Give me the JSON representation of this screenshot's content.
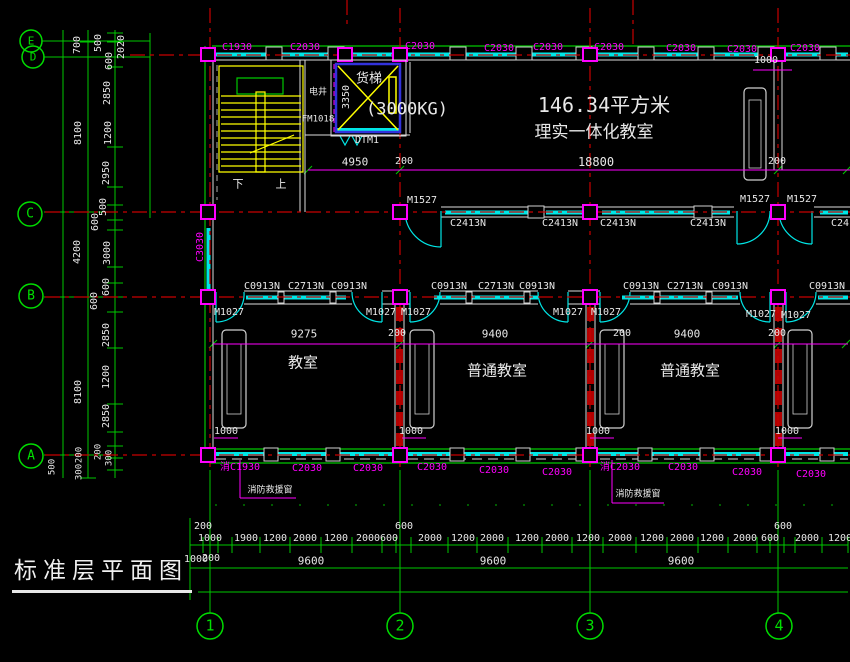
{
  "title": {
    "text": "标准层平面图"
  },
  "colors": {
    "background": "#000000",
    "grid_red": "#c80000",
    "dim_green": "#00d200",
    "window_cyan": "#00e6e6",
    "label_magenta": "#ff00ff",
    "stair_yellow": "#ffff00",
    "text_white": "#e8e8e8",
    "elevator_blue": "#3232dc"
  },
  "axis_bubbles": {
    "left": [
      "E",
      "D",
      "C",
      "B",
      "A"
    ],
    "bottom": [
      "1",
      "2",
      "3",
      "4"
    ]
  },
  "rooms": [
    "理实一体化教室",
    "教室",
    "普通教室",
    "普通教室",
    "电井",
    "货梯"
  ],
  "texts": [
    {
      "n": "dim-left",
      "t": "700",
      "x": 78,
      "y": 45,
      "s": 10,
      "r": 1
    },
    {
      "n": "dim-left",
      "t": "500",
      "x": 99,
      "y": 43,
      "s": 10,
      "r": 1
    },
    {
      "n": "dim-left",
      "t": "600",
      "x": 110,
      "y": 61,
      "s": 10,
      "r": 1
    },
    {
      "n": "dim-left",
      "t": "2020",
      "x": 122,
      "y": 47,
      "s": 10,
      "r": 1
    },
    {
      "n": "dim-left",
      "t": "2850",
      "x": 108,
      "y": 93,
      "s": 10,
      "r": 1
    },
    {
      "n": "dim-left",
      "t": "8100",
      "x": 79,
      "y": 133,
      "s": 10,
      "r": 1
    },
    {
      "n": "dim-left",
      "t": "1200",
      "x": 109,
      "y": 133,
      "s": 10,
      "r": 1
    },
    {
      "n": "dim-left",
      "t": "2950",
      "x": 107,
      "y": 173,
      "s": 10,
      "r": 1
    },
    {
      "n": "dim-left",
      "t": "500",
      "x": 104,
      "y": 207,
      "s": 10,
      "r": 1
    },
    {
      "n": "dim-left",
      "t": "600",
      "x": 96,
      "y": 222,
      "s": 10,
      "r": 1
    },
    {
      "n": "dim-left",
      "t": "4200",
      "x": 78,
      "y": 252,
      "s": 10,
      "r": 1
    },
    {
      "n": "dim-left",
      "t": "3000",
      "x": 108,
      "y": 253,
      "s": 10,
      "r": 1
    },
    {
      "n": "dim-left",
      "t": "600",
      "x": 107,
      "y": 287,
      "s": 10,
      "r": 1
    },
    {
      "n": "dim-left",
      "t": "600",
      "x": 95,
      "y": 301,
      "s": 10,
      "r": 1
    },
    {
      "n": "dim-left",
      "t": "2850",
      "x": 107,
      "y": 335,
      "s": 10,
      "r": 1
    },
    {
      "n": "dim-left",
      "t": "8100",
      "x": 79,
      "y": 392,
      "s": 10,
      "r": 1
    },
    {
      "n": "dim-left",
      "t": "1200",
      "x": 107,
      "y": 377,
      "s": 10,
      "r": 1
    },
    {
      "n": "dim-left",
      "t": "2850",
      "x": 107,
      "y": 416,
      "s": 10,
      "r": 1
    },
    {
      "n": "dim-left",
      "t": "500",
      "x": 53,
      "y": 467,
      "s": 9,
      "r": 1
    },
    {
      "n": "dim-left",
      "t": "200",
      "x": 80,
      "y": 455,
      "s": 9,
      "r": 1
    },
    {
      "n": "dim-left",
      "t": "300",
      "x": 80,
      "y": 472,
      "s": 9,
      "r": 1
    },
    {
      "n": "dim-left",
      "t": "200",
      "x": 99,
      "y": 452,
      "s": 9,
      "r": 1
    },
    {
      "n": "dim-left",
      "t": "300",
      "x": 110,
      "y": 458,
      "s": 9,
      "r": 1
    },
    {
      "n": "window-label-top",
      "t": "C1930",
      "x": 237,
      "y": 48,
      "s": 10,
      "c": "#ff00ff"
    },
    {
      "n": "window-label-top",
      "t": "C2030",
      "x": 305,
      "y": 48,
      "s": 10,
      "c": "#ff00ff"
    },
    {
      "n": "window-label-top",
      "t": "C2030",
      "x": 420,
      "y": 47,
      "s": 10,
      "c": "#ff00ff"
    },
    {
      "n": "window-label-top",
      "t": "C2030",
      "x": 499,
      "y": 49,
      "s": 10,
      "c": "#ff00ff"
    },
    {
      "n": "window-label-top",
      "t": "C2030",
      "x": 548,
      "y": 48,
      "s": 10,
      "c": "#ff00ff"
    },
    {
      "n": "window-label-top",
      "t": "C2030",
      "x": 609,
      "y": 48,
      "s": 10,
      "c": "#ff00ff"
    },
    {
      "n": "window-label-top",
      "t": "C2030",
      "x": 681,
      "y": 49,
      "s": 10,
      "c": "#ff00ff"
    },
    {
      "n": "window-label-top",
      "t": "C2030",
      "x": 742,
      "y": 50,
      "s": 10,
      "c": "#ff00ff"
    },
    {
      "n": "window-label-top",
      "t": "C2030",
      "x": 805,
      "y": 49,
      "s": 10,
      "c": "#ff00ff"
    },
    {
      "n": "dim-plan",
      "t": "1000",
      "x": 766,
      "y": 61,
      "s": 10
    },
    {
      "n": "room-label-shaft",
      "t": "电井",
      "x": 318,
      "y": 93,
      "s": 9
    },
    {
      "n": "door-label",
      "t": "FM1018",
      "x": 318,
      "y": 120,
      "s": 9
    },
    {
      "n": "room-label-elevator",
      "t": "货梯",
      "x": 369,
      "y": 79,
      "s": 13
    },
    {
      "n": "dim-plan",
      "t": "3350",
      "x": 347,
      "y": 97,
      "s": 10,
      "r": 1
    },
    {
      "n": "elevator-capacity",
      "t": "(3000KG)",
      "x": 407,
      "y": 110,
      "s": 17
    },
    {
      "n": "elevator-tag",
      "t": "DTM1",
      "x": 367,
      "y": 141,
      "s": 10
    },
    {
      "n": "stair-down-label",
      "t": "下",
      "x": 238,
      "y": 184,
      "s": 11
    },
    {
      "n": "stair-up-label",
      "t": "上",
      "x": 281,
      "y": 184,
      "s": 11
    },
    {
      "n": "dim-plan",
      "t": "4950",
      "x": 355,
      "y": 162,
      "s": 11
    },
    {
      "n": "dim-plan",
      "t": "200",
      "x": 404,
      "y": 162,
      "s": 10
    },
    {
      "n": "dim-plan",
      "t": "18800",
      "x": 596,
      "y": 162,
      "s": 12
    },
    {
      "n": "dim-plan",
      "t": "200",
      "x": 777,
      "y": 162,
      "s": 10
    },
    {
      "n": "room-area-label",
      "t": "146.34平方米",
      "x": 604,
      "y": 105,
      "s": 20
    },
    {
      "n": "room-label",
      "t": "理实一体化教室",
      "x": 594,
      "y": 133,
      "s": 17
    },
    {
      "n": "door-label",
      "t": "M1527",
      "x": 422,
      "y": 201,
      "s": 10
    },
    {
      "n": "window-label",
      "t": "C2413N",
      "x": 468,
      "y": 224,
      "s": 10
    },
    {
      "n": "window-label",
      "t": "C2413N",
      "x": 560,
      "y": 224,
      "s": 10
    },
    {
      "n": "window-label",
      "t": "C2413N",
      "x": 618,
      "y": 224,
      "s": 10
    },
    {
      "n": "window-label",
      "t": "C2413N",
      "x": 708,
      "y": 224,
      "s": 10
    },
    {
      "n": "door-label",
      "t": "M1527",
      "x": 755,
      "y": 200,
      "s": 10
    },
    {
      "n": "door-label",
      "t": "M1527",
      "x": 802,
      "y": 200,
      "s": 10
    },
    {
      "n": "window-label",
      "t": "C2413N",
      "x": 849,
      "y": 224,
      "s": 10
    },
    {
      "n": "window-label",
      "t": "C3030",
      "x": 201,
      "y": 247,
      "s": 10,
      "r": 1,
      "c": "#ff00ff"
    },
    {
      "n": "window-label",
      "t": "C0913N",
      "x": 262,
      "y": 287,
      "s": 10
    },
    {
      "n": "window-label",
      "t": "C2713N",
      "x": 306,
      "y": 287,
      "s": 10
    },
    {
      "n": "window-label",
      "t": "C0913N",
      "x": 349,
      "y": 287,
      "s": 10
    },
    {
      "n": "window-label",
      "t": "C0913N",
      "x": 449,
      "y": 287,
      "s": 10
    },
    {
      "n": "window-label",
      "t": "C2713N",
      "x": 496,
      "y": 287,
      "s": 10
    },
    {
      "n": "window-label",
      "t": "C0913N",
      "x": 537,
      "y": 287,
      "s": 10
    },
    {
      "n": "window-label",
      "t": "C0913N",
      "x": 641,
      "y": 287,
      "s": 10
    },
    {
      "n": "window-label",
      "t": "C2713N",
      "x": 685,
      "y": 287,
      "s": 10
    },
    {
      "n": "window-label",
      "t": "C0913N",
      "x": 730,
      "y": 287,
      "s": 10
    },
    {
      "n": "window-label",
      "t": "C0913N",
      "x": 827,
      "y": 287,
      "s": 10
    },
    {
      "n": "door-label",
      "t": "M1027",
      "x": 229,
      "y": 313,
      "s": 10
    },
    {
      "n": "door-label",
      "t": "M1027",
      "x": 381,
      "y": 313,
      "s": 10
    },
    {
      "n": "door-label",
      "t": "M1027",
      "x": 416,
      "y": 313,
      "s": 10
    },
    {
      "n": "door-label",
      "t": "M1027",
      "x": 568,
      "y": 313,
      "s": 10
    },
    {
      "n": "door-label",
      "t": "M1027",
      "x": 606,
      "y": 313,
      "s": 10
    },
    {
      "n": "door-label",
      "t": "M1027",
      "x": 761,
      "y": 315,
      "s": 10
    },
    {
      "n": "door-label",
      "t": "M1027",
      "x": 796,
      "y": 316,
      "s": 10
    },
    {
      "n": "dim-plan",
      "t": "9275",
      "x": 304,
      "y": 334,
      "s": 11
    },
    {
      "n": "dim-plan",
      "t": "200",
      "x": 397,
      "y": 334,
      "s": 10
    },
    {
      "n": "dim-plan",
      "t": "9400",
      "x": 495,
      "y": 334,
      "s": 11
    },
    {
      "n": "dim-plan",
      "t": "200",
      "x": 622,
      "y": 334,
      "s": 10
    },
    {
      "n": "dim-plan",
      "t": "9400",
      "x": 687,
      "y": 334,
      "s": 11
    },
    {
      "n": "dim-plan",
      "t": "200",
      "x": 777,
      "y": 334,
      "s": 10
    },
    {
      "n": "room-label",
      "t": "教室",
      "x": 303,
      "y": 363,
      "s": 15
    },
    {
      "n": "room-label",
      "t": "普通教室",
      "x": 497,
      "y": 371,
      "s": 15
    },
    {
      "n": "room-label",
      "t": "普通教室",
      "x": 690,
      "y": 371,
      "s": 15
    },
    {
      "n": "dim-plan",
      "t": "1000",
      "x": 226,
      "y": 432,
      "s": 10
    },
    {
      "n": "dim-plan",
      "t": "1000",
      "x": 411,
      "y": 432,
      "s": 10
    },
    {
      "n": "dim-plan",
      "t": "1000",
      "x": 598,
      "y": 432,
      "s": 10
    },
    {
      "n": "dim-plan",
      "t": "1000",
      "x": 787,
      "y": 432,
      "s": 10
    },
    {
      "n": "window-label-bottom",
      "t": "消C1930",
      "x": 240,
      "y": 468,
      "s": 10,
      "c": "#ff00ff"
    },
    {
      "n": "window-label-bottom",
      "t": "C2030",
      "x": 307,
      "y": 469,
      "s": 10,
      "c": "#ff00ff"
    },
    {
      "n": "window-label-bottom",
      "t": "C2030",
      "x": 368,
      "y": 469,
      "s": 10,
      "c": "#ff00ff"
    },
    {
      "n": "window-label-bottom",
      "t": "C2030",
      "x": 432,
      "y": 468,
      "s": 10,
      "c": "#ff00ff"
    },
    {
      "n": "window-label-bottom",
      "t": "C2030",
      "x": 494,
      "y": 471,
      "s": 10,
      "c": "#ff00ff"
    },
    {
      "n": "window-label-bottom",
      "t": "C2030",
      "x": 557,
      "y": 473,
      "s": 10,
      "c": "#ff00ff"
    },
    {
      "n": "window-label-bottom",
      "t": "消C2030",
      "x": 620,
      "y": 468,
      "s": 10,
      "c": "#ff00ff"
    },
    {
      "n": "window-label-bottom",
      "t": "C2030",
      "x": 683,
      "y": 468,
      "s": 10,
      "c": "#ff00ff"
    },
    {
      "n": "window-label-bottom",
      "t": "C2030",
      "x": 747,
      "y": 473,
      "s": 10,
      "c": "#ff00ff"
    },
    {
      "n": "window-label-bottom",
      "t": "C2030",
      "x": 811,
      "y": 475,
      "s": 10,
      "c": "#ff00ff"
    },
    {
      "n": "fire-window-callout",
      "t": "消防救援窗",
      "x": 270,
      "y": 491,
      "s": 9
    },
    {
      "n": "fire-window-callout",
      "t": "消防救援窗",
      "x": 638,
      "y": 495,
      "s": 9
    },
    {
      "n": "dim-bottom",
      "t": "200",
      "x": 203,
      "y": 527,
      "s": 10
    },
    {
      "n": "dim-bottom",
      "t": "1000",
      "x": 210,
      "y": 539,
      "s": 10
    },
    {
      "n": "dim-bottom",
      "t": "1900",
      "x": 246,
      "y": 539,
      "s": 10
    },
    {
      "n": "dim-bottom",
      "t": "1200",
      "x": 275,
      "y": 539,
      "s": 10
    },
    {
      "n": "dim-bottom",
      "t": "2000",
      "x": 305,
      "y": 539,
      "s": 10
    },
    {
      "n": "dim-bottom",
      "t": "1200",
      "x": 336,
      "y": 539,
      "s": 10
    },
    {
      "n": "dim-bottom",
      "t": "2000",
      "x": 368,
      "y": 539,
      "s": 10
    },
    {
      "n": "dim-bottom",
      "t": "600",
      "x": 389,
      "y": 539,
      "s": 10
    },
    {
      "n": "dim-bottom",
      "t": "600",
      "x": 404,
      "y": 527,
      "s": 10
    },
    {
      "n": "dim-bottom",
      "t": "2000",
      "x": 430,
      "y": 539,
      "s": 10
    },
    {
      "n": "dim-bottom",
      "t": "1200",
      "x": 463,
      "y": 539,
      "s": 10
    },
    {
      "n": "dim-bottom",
      "t": "2000",
      "x": 492,
      "y": 539,
      "s": 10
    },
    {
      "n": "dim-bottom",
      "t": "1200",
      "x": 527,
      "y": 539,
      "s": 10
    },
    {
      "n": "dim-bottom",
      "t": "2000",
      "x": 557,
      "y": 539,
      "s": 10
    },
    {
      "n": "dim-bottom",
      "t": "1200",
      "x": 588,
      "y": 539,
      "s": 10
    },
    {
      "n": "dim-bottom",
      "t": "2000",
      "x": 620,
      "y": 539,
      "s": 10
    },
    {
      "n": "dim-bottom",
      "t": "1200",
      "x": 652,
      "y": 539,
      "s": 10
    },
    {
      "n": "dim-bottom",
      "t": "2000",
      "x": 682,
      "y": 539,
      "s": 10
    },
    {
      "n": "dim-bottom",
      "t": "1200",
      "x": 712,
      "y": 539,
      "s": 10
    },
    {
      "n": "dim-bottom",
      "t": "2000",
      "x": 745,
      "y": 539,
      "s": 10
    },
    {
      "n": "dim-bottom",
      "t": "600",
      "x": 770,
      "y": 539,
      "s": 10
    },
    {
      "n": "dim-bottom",
      "t": "600",
      "x": 783,
      "y": 527,
      "s": 10
    },
    {
      "n": "dim-bottom",
      "t": "2000",
      "x": 807,
      "y": 539,
      "s": 10
    },
    {
      "n": "dim-bottom",
      "t": "1200",
      "x": 840,
      "y": 539,
      "s": 10
    },
    {
      "n": "dim-bottom",
      "t": "1000",
      "x": 196,
      "y": 560,
      "s": 10
    },
    {
      "n": "dim-bottom",
      "t": "200",
      "x": 211,
      "y": 559,
      "s": 10
    },
    {
      "n": "dim-bottom",
      "t": "9600",
      "x": 311,
      "y": 561,
      "s": 11
    },
    {
      "n": "dim-bottom",
      "t": "9600",
      "x": 493,
      "y": 561,
      "s": 11
    },
    {
      "n": "dim-bottom",
      "t": "9600",
      "x": 681,
      "y": 561,
      "s": 11
    },
    {
      "n": "grid-letter-E",
      "t": "E",
      "x": 31,
      "y": 41,
      "s": 11,
      "c": "#00e000"
    },
    {
      "n": "grid-letter-D",
      "t": "D",
      "x": 33,
      "y": 57,
      "s": 11,
      "c": "#00e000"
    },
    {
      "n": "grid-letter-C",
      "t": "C",
      "x": 30,
      "y": 214,
      "s": 13,
      "c": "#00e000"
    },
    {
      "n": "grid-letter-B",
      "t": "B",
      "x": 31,
      "y": 296,
      "s": 13,
      "c": "#00e000"
    },
    {
      "n": "grid-letter-A",
      "t": "A",
      "x": 31,
      "y": 456,
      "s": 13,
      "c": "#00e000"
    },
    {
      "n": "grid-number-1",
      "t": "1",
      "x": 210,
      "y": 626,
      "s": 15,
      "c": "#00e000"
    },
    {
      "n": "grid-number-2",
      "t": "2",
      "x": 400,
      "y": 626,
      "s": 15,
      "c": "#00e000"
    },
    {
      "n": "grid-number-3",
      "t": "3",
      "x": 590,
      "y": 626,
      "s": 15,
      "c": "#00e000"
    },
    {
      "n": "grid-number-4",
      "t": "4",
      "x": 779,
      "y": 626,
      "s": 15,
      "c": "#00e000"
    }
  ]
}
